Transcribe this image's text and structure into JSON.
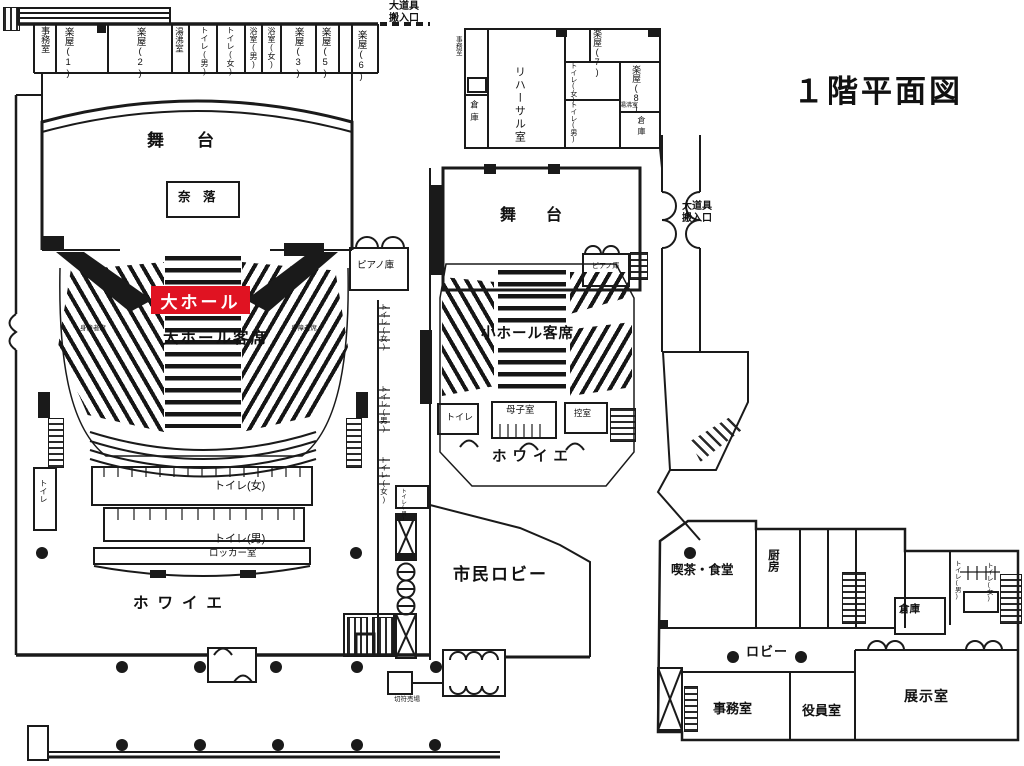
{
  "title": "１階平面図",
  "highlight": {
    "label": "大ホール",
    "color": "#e01322"
  },
  "colors": {
    "accent_red": "#e01322",
    "line": "#1a1a1a",
    "background": "#ffffff"
  },
  "labels": [
    {
      "id": "office-nw",
      "text": "事務室"
    },
    {
      "id": "dressing-1",
      "text": "楽屋(1)"
    },
    {
      "id": "dressing-2",
      "text": "楽屋(2)"
    },
    {
      "id": "kettle-nw",
      "text": "湯沸室"
    },
    {
      "id": "toilet-m-nw",
      "text": "トイレ(男)"
    },
    {
      "id": "toilet-f-nw",
      "text": "トイレ(女)"
    },
    {
      "id": "bath-m",
      "text": "浴室(男)"
    },
    {
      "id": "bath-f",
      "text": "浴室(女)"
    },
    {
      "id": "dressing-3",
      "text": "楽屋(3)"
    },
    {
      "id": "dressing-5",
      "text": "楽屋(5)"
    },
    {
      "id": "dressing-6",
      "text": "楽屋(6)"
    },
    {
      "id": "prop-entrance-top",
      "text": "大道具\n搬入口"
    },
    {
      "id": "office-backstage",
      "text": "事務室"
    },
    {
      "id": "rehearsal-room",
      "text": "リハーサル室"
    },
    {
      "id": "storage-rehearsal",
      "text": "倉庫"
    },
    {
      "id": "dressing-7",
      "text": "楽屋(7)"
    },
    {
      "id": "toilet-f-ne",
      "text": "トイレ(女)"
    },
    {
      "id": "toilet-m-ne",
      "text": "トイレ(男)"
    },
    {
      "id": "dressing-8",
      "text": "楽屋(8)"
    },
    {
      "id": "kettle-ne",
      "text": "湯沸室"
    },
    {
      "id": "storage-ne",
      "text": "倉庫"
    },
    {
      "id": "stage-main",
      "text": "舞　台"
    },
    {
      "id": "naraku",
      "text": "奈　落"
    },
    {
      "id": "piano-storage-main",
      "text": "ピアノ庫"
    },
    {
      "id": "main-hall-seats",
      "text": "大ホール客席"
    },
    {
      "id": "disabled-seats-left",
      "text": "身障者席"
    },
    {
      "id": "disabled-seats-right",
      "text": "身障者席"
    },
    {
      "id": "stage-small",
      "text": "舞　台"
    },
    {
      "id": "prop-entrance-right",
      "text": "大道具\n搬入口"
    },
    {
      "id": "piano-storage-small",
      "text": "ピアノ庫"
    },
    {
      "id": "small-hall-seats",
      "text": "小ホール客席"
    },
    {
      "id": "toilet-small-hall",
      "text": "トイレ"
    },
    {
      "id": "mother-child-room",
      "text": "母子室"
    },
    {
      "id": "waiting-room",
      "text": "控室"
    },
    {
      "id": "foyer-small",
      "text": "ホワイエ"
    },
    {
      "id": "toilet-west",
      "text": "トイレ"
    },
    {
      "id": "toilet-f-main",
      "text": "トイレ(女)"
    },
    {
      "id": "toilet-m-main",
      "text": "トイレ(男)"
    },
    {
      "id": "locker-room",
      "text": "ロッカー室"
    },
    {
      "id": "foyer-main",
      "text": "ホワイエ"
    },
    {
      "id": "civic-lobby",
      "text": "市民ロビー"
    },
    {
      "id": "ticket-booth",
      "text": "切符売場"
    },
    {
      "id": "cafe",
      "text": "喫茶・食堂"
    },
    {
      "id": "kitchen",
      "text": "厨房"
    },
    {
      "id": "storage-annex",
      "text": "倉庫"
    },
    {
      "id": "toilet-m-annex",
      "text": "トイレ(男)"
    },
    {
      "id": "toilet-f-annex",
      "text": "トイレ(女)"
    },
    {
      "id": "lobby-annex",
      "text": "ロビー"
    },
    {
      "id": "office-annex",
      "text": "事務室"
    },
    {
      "id": "executive-room",
      "text": "役員室"
    },
    {
      "id": "exhibition-room",
      "text": "展示室"
    },
    {
      "id": "toilet-f-strip1",
      "text": "トイレ(女)"
    },
    {
      "id": "toilet-m-strip",
      "text": "トイレ(男)"
    },
    {
      "id": "toilet-f-strip2",
      "text": "トイレ(女)"
    },
    {
      "id": "toilet-m-strip-small",
      "text": "トイレ(男)"
    }
  ]
}
